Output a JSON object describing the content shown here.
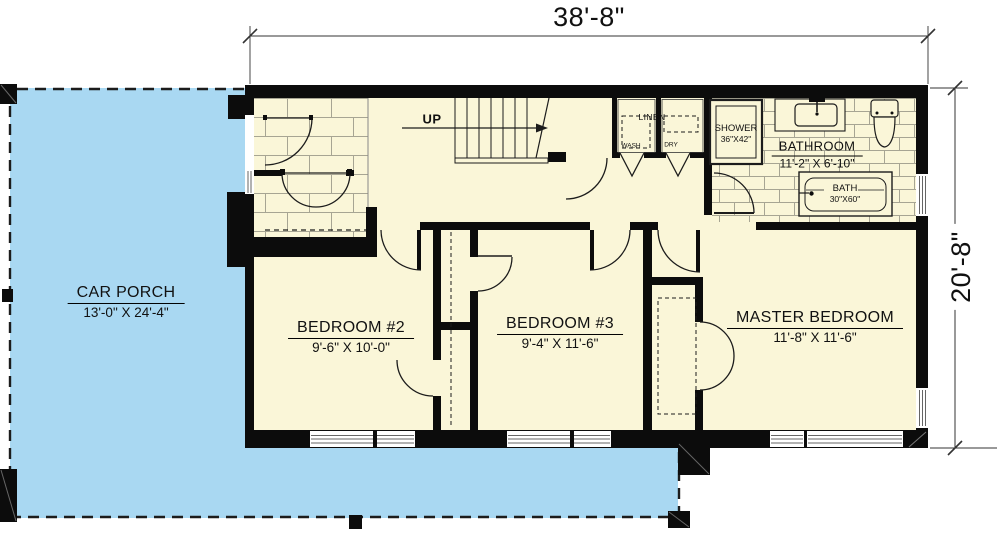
{
  "dimensions": {
    "width": "38'-8\"",
    "height": "20'-8\""
  },
  "rooms": {
    "car_porch": {
      "name": "CAR PORCH",
      "size": "13'-0\" X 24'-4\""
    },
    "bedroom2": {
      "name": "BEDROOM #2",
      "size": "9'-6\" X 10'-0\""
    },
    "bedroom3": {
      "name": "BEDROOM #3",
      "size": "9'-4\" X 11'-6\""
    },
    "master_bedroom": {
      "name": "MASTER BEDROOM",
      "size": "11'-8\" X 11'-6\""
    },
    "bathroom": {
      "name": "BATHROOM",
      "size": "11'-2\" X 6'-10\""
    }
  },
  "fixtures": {
    "shower": {
      "name": "SHOWER",
      "size": "36\"X42\""
    },
    "bath": {
      "name": "BATH",
      "size": "30\"X60\""
    },
    "linen": "LINEN",
    "wash": "WASH",
    "dry": "DRY"
  },
  "stairs": {
    "direction_label": "UP"
  },
  "colors": {
    "porch": "#a9d8f2",
    "room": "#faf6d8",
    "wall": "#0c0c0c",
    "tile_line": "#a7a593",
    "line": "#1c1c1c"
  }
}
